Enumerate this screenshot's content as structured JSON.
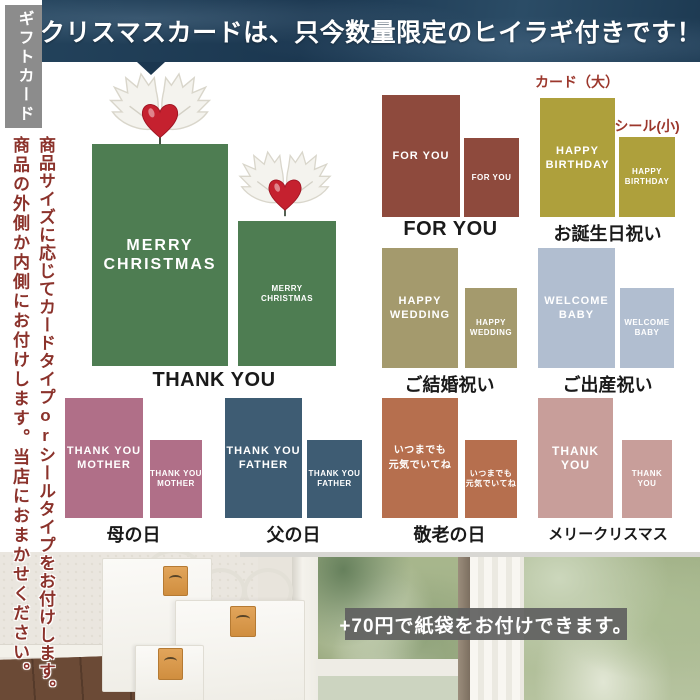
{
  "banner": {
    "text": "クリスマスカードは、只今数量限定のヒイラギ付きです！",
    "bg_color": "#1d3a52"
  },
  "sidebar": {
    "tab": "ギフトカード",
    "note1": "商品サイズに応じてカードタイプorシールタイプをお付けします。",
    "note2": "商品の外側か内側にお付けします。当店におまかせください。",
    "note_color": "#8b322b"
  },
  "legend": {
    "card_large": "カード（大）",
    "seal_small": "シール(小)",
    "color": "#9c372c"
  },
  "sections": [
    {
      "name": "christmas",
      "line1": "MERRY",
      "line2": "CHRISTMAS",
      "label": "THANK YOU",
      "color": "#4e7d52"
    },
    {
      "name": "for-you",
      "line1": "FOR YOU",
      "line2": "",
      "label": "FOR YOU",
      "color": "#8e4a3d"
    },
    {
      "name": "birthday",
      "line1": "HAPPY",
      "line2": "BIRTHDAY",
      "label": "お誕生日祝い",
      "color": "#aea03c"
    },
    {
      "name": "wedding",
      "line1": "HAPPY",
      "line2": "WEDDING",
      "label": "ご結婚祝い",
      "color": "#a49a6d"
    },
    {
      "name": "baby",
      "line1": "WELCOME",
      "line2": "BABY",
      "label": "ご出産祝い",
      "color": "#b1bed0"
    },
    {
      "name": "mother",
      "line1": "THANK YOU",
      "line2": "MOTHER",
      "label": "母の日",
      "color": "#b06f88"
    },
    {
      "name": "father",
      "line1": "THANK YOU",
      "line2": "FATHER",
      "label": "父の日",
      "color": "#3e5c73"
    },
    {
      "name": "respect-for-aged",
      "line1": "いつまでも",
      "line2": "元気でいてね",
      "label": "敬老の日",
      "color": "#b66f4e"
    },
    {
      "name": "merry-christmas",
      "line1": "THANK YOU",
      "line2": "",
      "label": "メリークリスマス",
      "color": "#c89e9a"
    }
  ],
  "photo": {
    "overlay": "+70円で紙袋をお付けできます。"
  }
}
